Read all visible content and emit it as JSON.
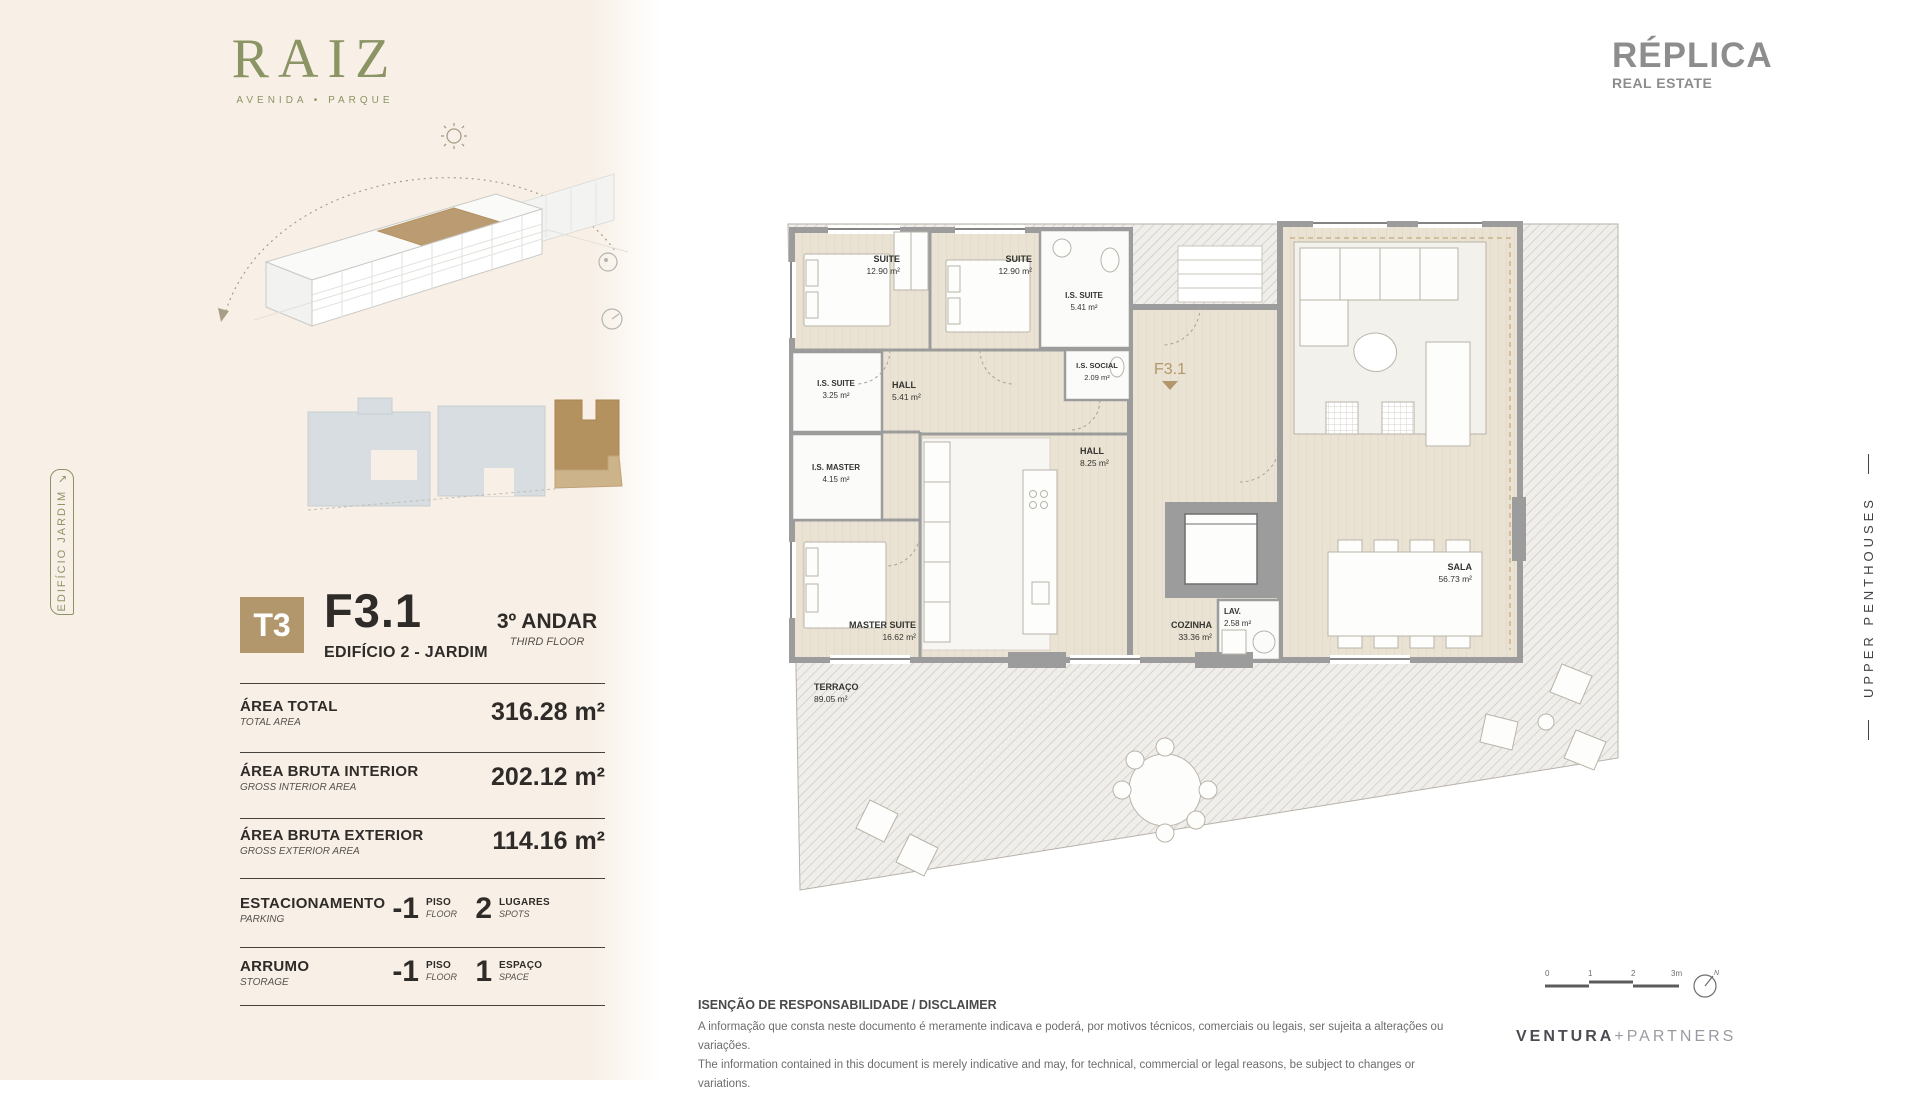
{
  "brand": {
    "logo": "RAIZ",
    "tagline": "AVENIDA • PARQUE"
  },
  "agency": {
    "name": "RÉPLICA",
    "subtitle": "REAL ESTATE"
  },
  "partner": {
    "left": "VENTURA",
    "plus": "+",
    "right": "PARTNERS"
  },
  "side_labels": {
    "left": "EDIFÍCIO JARDIM",
    "left_arrow": "↘",
    "right": "UPPER PENTHOUSES"
  },
  "unit": {
    "type": "T3",
    "code": "F3.1",
    "building": "EDIFÍCIO 2 - JARDIM",
    "floor": "3º ANDAR",
    "floor_en": "THIRD FLOOR"
  },
  "areas": [
    {
      "label": "ÁREA TOTAL",
      "label_en": "TOTAL AREA",
      "value": "316.28 m²"
    },
    {
      "label": "ÁREA BRUTA INTERIOR",
      "label_en": "GROSS INTERIOR AREA",
      "value": "202.12 m²"
    },
    {
      "label": "ÁREA BRUTA EXTERIOR",
      "label_en": "GROSS EXTERIOR AREA",
      "value": "114.16 m²"
    }
  ],
  "amenities": [
    {
      "label": "ESTACIONAMENTO",
      "label_en": "PARKING",
      "items": [
        {
          "value": "-1",
          "unit": "PISO",
          "unit_en": "FLOOR"
        },
        {
          "value": "2",
          "unit": "LUGARES",
          "unit_en": "SPOTS"
        }
      ]
    },
    {
      "label": "ARRUMO",
      "label_en": "STORAGE",
      "items": [
        {
          "value": "-1",
          "unit": "PISO",
          "unit_en": "FLOOR"
        },
        {
          "value": "1",
          "unit": "ESPAÇO",
          "unit_en": "SPACE"
        }
      ]
    }
  ],
  "plan": {
    "marker": "F3.1",
    "rooms": [
      {
        "name": "SUITE",
        "area": "12.90 m²"
      },
      {
        "name": "SUITE",
        "area": "12.90 m²"
      },
      {
        "name": "I.S. SUITE",
        "area": "5.41 m²"
      },
      {
        "name": "I.S. SOCIAL",
        "area": "2.09 m²"
      },
      {
        "name": "I.S. SUITE",
        "area": "3.25 m²"
      },
      {
        "name": "HALL",
        "area": "5.41 m²"
      },
      {
        "name": "HALL",
        "area": "8.25 m²"
      },
      {
        "name": "I.S. MASTER",
        "area": "4.15 m²"
      },
      {
        "name": "MASTER SUITE",
        "area": "16.62 m²"
      },
      {
        "name": "COZINHA",
        "area": "33.36 m²"
      },
      {
        "name": "LAV.",
        "area": "2.58 m²"
      },
      {
        "name": "SALA",
        "area": "56.73 m²"
      },
      {
        "name": "TERRAÇO",
        "area": "89.05 m²"
      }
    ]
  },
  "scalebar": {
    "ticks": [
      "0",
      "1",
      "2",
      "3m"
    ],
    "north": "N"
  },
  "disclaimer": {
    "title": "ISENÇÃO DE RESPONSABILIDADE / DISCLAIMER",
    "line1": "A informação que consta neste documento é meramente indicava e poderá, por motivos técnicos, comerciais ou legais, ser sujeita a alterações ou variações.",
    "line2": "The information contained in this document is merely indicative and may, for technical, commercial or legal reasons, be subject to changes or variations."
  },
  "colors": {
    "accent_tan": "#b3976c",
    "olive": "#8b9464",
    "wall_gray": "#9c9c9c",
    "cream": "#f8f0e7"
  }
}
